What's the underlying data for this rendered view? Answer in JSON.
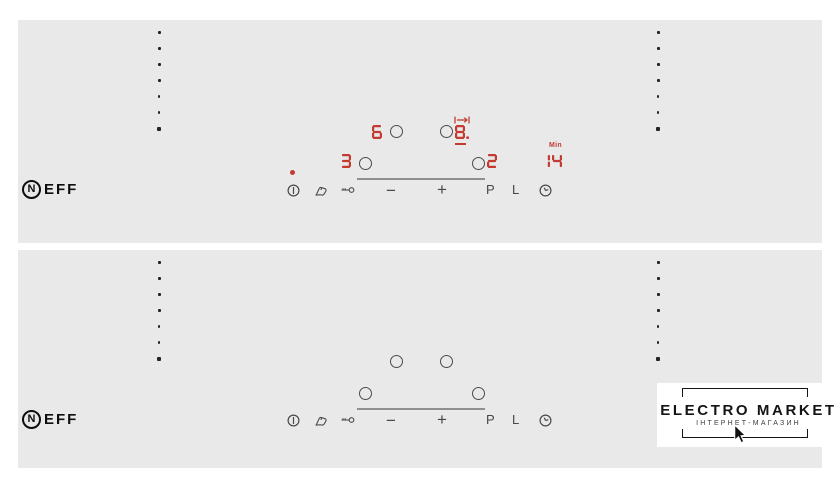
{
  "brand": {
    "name": "NEFF",
    "logo_circle_letter": "N",
    "logo_text": "EFF"
  },
  "colors": {
    "panel_bg": "#e9e9e9",
    "led_red": "#c43b31",
    "icon_gray": "#4a4a4a"
  },
  "panels": {
    "top": {
      "state": "on",
      "displays": {
        "rear_left": "6",
        "rear_right": "8.",
        "front_left": "3",
        "front_right": "2",
        "timer": "14",
        "timer_unit": "Min"
      },
      "indicators": {
        "power_on_dot": true,
        "move_pan_arrow": true,
        "selected_zone_underline": "rear_right"
      }
    },
    "bottom": {
      "state": "off"
    }
  },
  "controls": {
    "minus": "−",
    "plus": "+",
    "boost": "P",
    "lock_keep_warm": "L"
  },
  "icons": {
    "power": "power-icon",
    "clean_lock": "touch-hand-icon",
    "child_lock": "key-icon",
    "timer": "clock-icon",
    "move_pan": "move-pan-icon"
  },
  "watermark": {
    "title": "ELECTRO MARKET",
    "subtitle": "ІНТЕРНЕТ-МАГАЗИН"
  },
  "decor": {
    "side_dots_per_column": 7
  }
}
